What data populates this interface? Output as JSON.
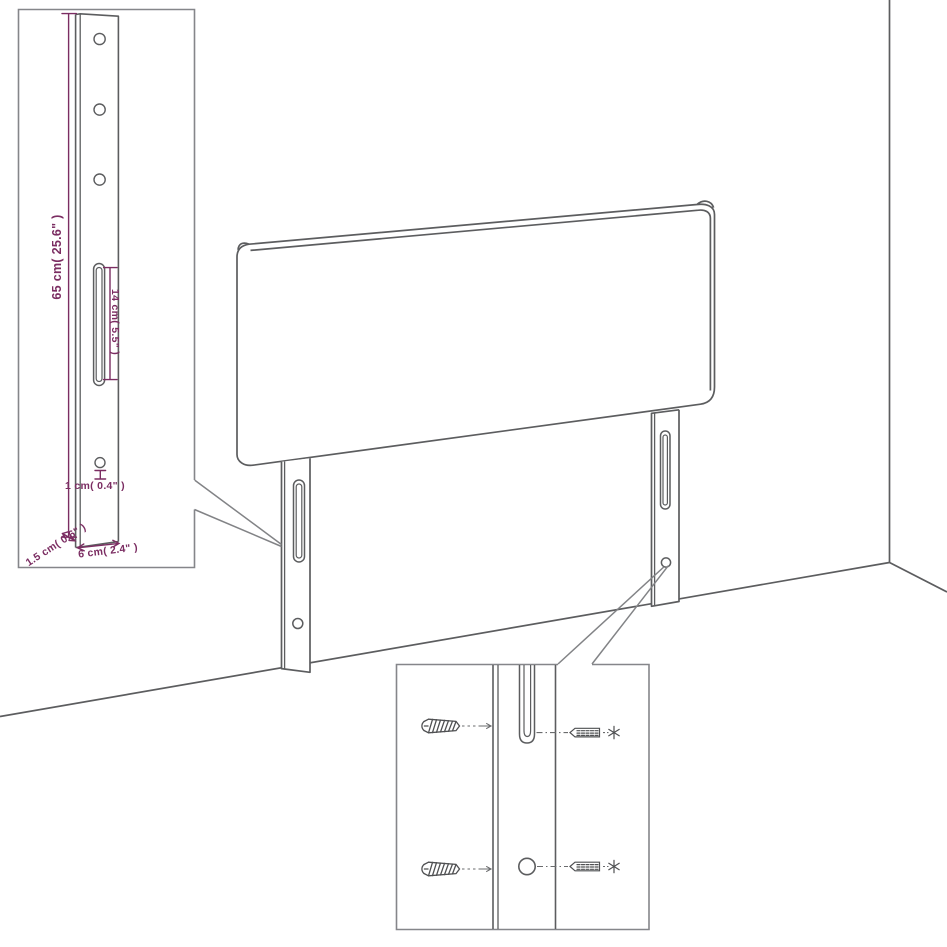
{
  "diagram": {
    "kind": "furniture-assembly-dimension-diagram",
    "subject": "upholstered headboard with two slotted legs, wall corner backdrop, two magnifier insets"
  },
  "colors": {
    "background": "#ffffff",
    "drawing_line": "#5c5d5f",
    "inset_border": "#85868a",
    "dimension": "#7b2d62"
  },
  "leg_inset": {
    "height_label": "65 cm( 25.6\" )",
    "slot_label": "14 cm( 5.5\" )",
    "hole_label": "1 cm( 0.4\" )",
    "thickness_label": "1.5 cm( 0.6\" )",
    "width_label": "6 cm( 2.4\" )"
  },
  "mounting_inset": {
    "icons": [
      "wood-screw-icon",
      "wood-screw-icon",
      "screw-side-icon",
      "screw-side-icon",
      "screw-head-star-icon",
      "screw-head-star-icon"
    ]
  }
}
